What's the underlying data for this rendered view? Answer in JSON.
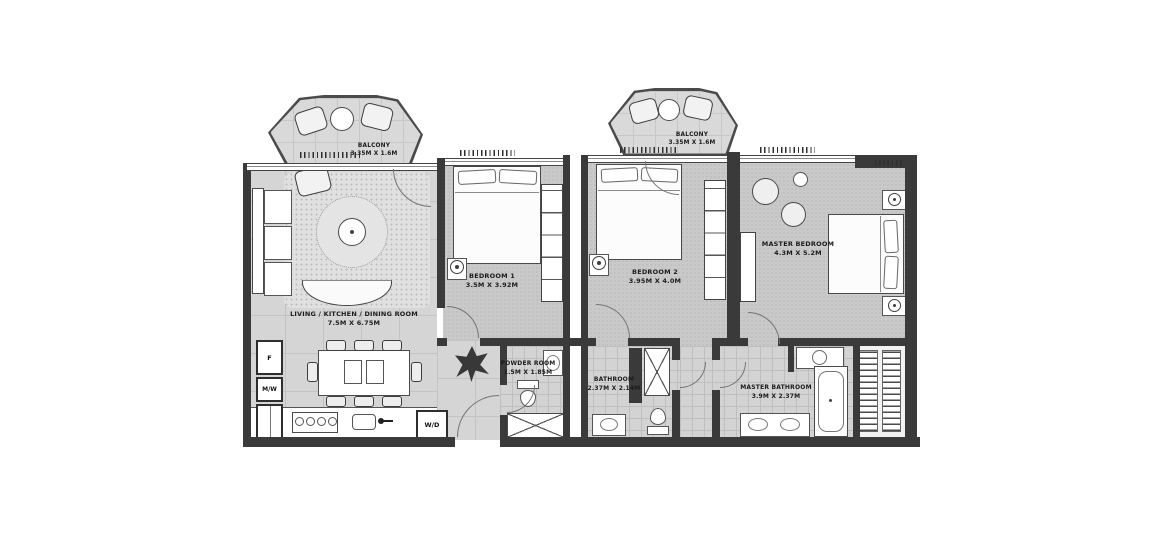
{
  "plan": {
    "balconies": [
      {
        "name": "BALCONY",
        "dims": "3.35M X 1.6M"
      },
      {
        "name": "BALCONY",
        "dims": "3.35M X 1.6M"
      }
    ],
    "living": {
      "name": "LIVING / KITCHEN / DINING ROOM",
      "dims": "7.5M X 6.75M"
    },
    "bedroom1": {
      "name": "BEDROOM 1",
      "dims": "3.5M X 3.92M"
    },
    "bedroom2": {
      "name": "BEDROOM 2",
      "dims": "3.95M X 4.0M"
    },
    "master_bedroom": {
      "name": "MASTER BEDROOM",
      "dims": "4.3M X 5.2M"
    },
    "powder_room": {
      "name": "POWDER ROOM",
      "dims": "1.5M X 1.85M"
    },
    "bathroom": {
      "name": "BATHROOM",
      "dims": "2.37M X 2.14M"
    },
    "master_bathroom": {
      "name": "MASTER BATHROOM",
      "dims": "3.9M X 2.37M"
    },
    "appliances": {
      "fridge": "F",
      "microwave": "M/W",
      "washer_dryer": "W/D"
    },
    "colors": {
      "wall": "#3a3a3a",
      "floor_bedroom": "#c9c9c9",
      "floor_living": "#d5d5d5",
      "fixture": "#ffffff"
    }
  }
}
